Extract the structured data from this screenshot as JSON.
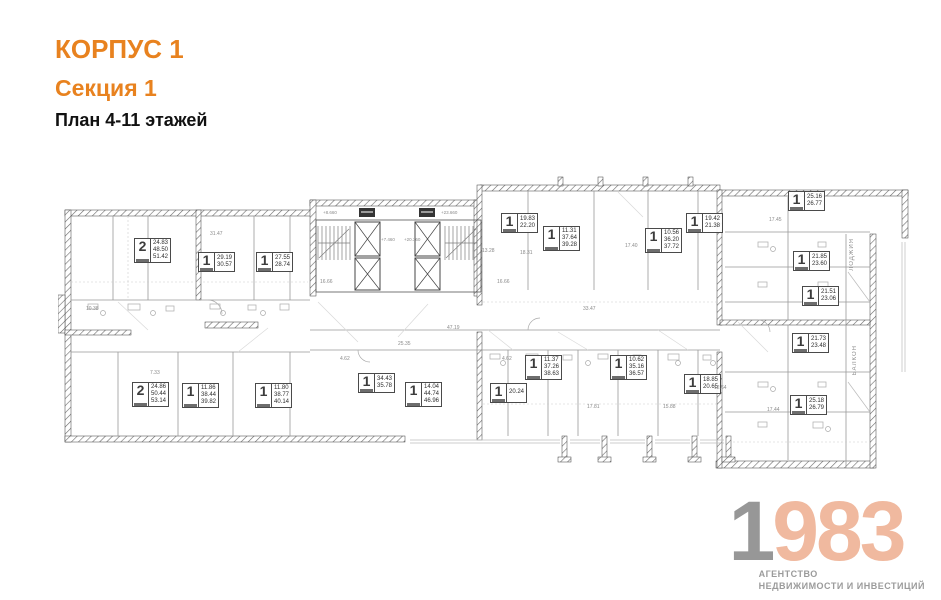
{
  "header": {
    "building": "КОРПУС 1",
    "section": "Секция 1",
    "plan": "План 4-11 этажей"
  },
  "colors": {
    "accent_orange": "#e8821f",
    "logo_gray": "#979797",
    "logo_salmon": "#f0b99f",
    "wall_line": "#4a4a4a"
  },
  "plan": {
    "apartments": [
      {
        "rooms": "2",
        "areas": [
          "24.83",
          "48.50",
          "51.42"
        ],
        "x": 134,
        "y": 238
      },
      {
        "rooms": "1",
        "areas": [
          "29.19",
          "30.57"
        ],
        "x": 198,
        "y": 252
      },
      {
        "rooms": "1",
        "areas": [
          "27.55",
          "28.74"
        ],
        "x": 256,
        "y": 252
      },
      {
        "rooms": "1",
        "areas": [
          "19.83",
          "22.20"
        ],
        "x": 501,
        "y": 213
      },
      {
        "rooms": "1",
        "areas": [
          "11.31",
          "37.64",
          "39.28"
        ],
        "x": 543,
        "y": 226
      },
      {
        "rooms": "1",
        "areas": [
          "10.56",
          "36.20",
          "37.72"
        ],
        "x": 645,
        "y": 228
      },
      {
        "rooms": "1",
        "areas": [
          "19.42",
          "21.38"
        ],
        "x": 686,
        "y": 213
      },
      {
        "rooms": "1",
        "areas": [
          "25.16",
          "26.77"
        ],
        "x": 788,
        "y": 191
      },
      {
        "rooms": "1",
        "areas": [
          "21.85",
          "23.60"
        ],
        "x": 793,
        "y": 251
      },
      {
        "rooms": "1",
        "areas": [
          "21.51",
          "23.06"
        ],
        "x": 802,
        "y": 286
      },
      {
        "rooms": "1",
        "areas": [
          "21.73",
          "23.48"
        ],
        "x": 792,
        "y": 333
      },
      {
        "rooms": "1",
        "areas": [
          "25.18",
          "26.79"
        ],
        "x": 790,
        "y": 395
      },
      {
        "rooms": "2",
        "areas": [
          "24.86",
          "50.44",
          "53.14"
        ],
        "x": 132,
        "y": 382
      },
      {
        "rooms": "1",
        "areas": [
          "11.86",
          "38.44",
          "39.82"
        ],
        "x": 182,
        "y": 383
      },
      {
        "rooms": "1",
        "areas": [
          "11.80",
          "38.77",
          "40.14"
        ],
        "x": 255,
        "y": 383
      },
      {
        "rooms": "1",
        "areas": [
          "34.43",
          "35.78"
        ],
        "x": 358,
        "y": 373
      },
      {
        "rooms": "1",
        "areas": [
          "14.04",
          "44.74",
          "46.96"
        ],
        "x": 405,
        "y": 382
      },
      {
        "rooms": "1",
        "areas": [
          "20.24"
        ],
        "x": 490,
        "y": 383
      },
      {
        "rooms": "1",
        "areas": [
          "11.37",
          "37.26",
          "38.63"
        ],
        "x": 525,
        "y": 355
      },
      {
        "rooms": "1",
        "areas": [
          "10.62",
          "35.16",
          "36.57"
        ],
        "x": 610,
        "y": 355
      },
      {
        "rooms": "1",
        "areas": [
          "18.85",
          "20.65"
        ],
        "x": 684,
        "y": 374
      }
    ],
    "dimensions": [
      {
        "t": "31.47",
        "x": 210,
        "y": 231
      },
      {
        "t": "16.66",
        "x": 320,
        "y": 279
      },
      {
        "t": "16.66",
        "x": 497,
        "y": 279
      },
      {
        "t": "25.35",
        "x": 398,
        "y": 341
      },
      {
        "t": "4.62",
        "x": 340,
        "y": 356
      },
      {
        "t": "4.62",
        "x": 502,
        "y": 356
      },
      {
        "t": "47.19",
        "x": 447,
        "y": 325
      },
      {
        "t": "17.40",
        "x": 625,
        "y": 243
      },
      {
        "t": "33.47",
        "x": 583,
        "y": 306
      },
      {
        "t": "18.31",
        "x": 520,
        "y": 250
      },
      {
        "t": "13.28",
        "x": 482,
        "y": 248
      },
      {
        "t": "17.45",
        "x": 769,
        "y": 217
      },
      {
        "t": "12.64",
        "x": 714,
        "y": 385
      },
      {
        "t": "17.81",
        "x": 587,
        "y": 404
      },
      {
        "t": "15.88",
        "x": 663,
        "y": 404
      },
      {
        "t": "17.44",
        "x": 767,
        "y": 407
      },
      {
        "t": "10.38",
        "x": 86,
        "y": 306
      },
      {
        "t": "7.33",
        "x": 150,
        "y": 370
      }
    ],
    "elevations": [
      {
        "t": "+8.660",
        "x": 323,
        "y": 210
      },
      {
        "t": "+23.660",
        "x": 441,
        "y": 210
      },
      {
        "t": "+7.460",
        "x": 381,
        "y": 237
      },
      {
        "t": "+20.360",
        "x": 404,
        "y": 237
      }
    ],
    "vertical_labels": [
      {
        "t": "ЛОДЖИЯ",
        "x": 849,
        "y": 238
      },
      {
        "t": "БАЛКОН",
        "x": 852,
        "y": 345
      }
    ]
  },
  "logo": {
    "year_first": "1",
    "year_rest": "983",
    "line1": "АГЕНТСТВО",
    "line2": "НЕДВИЖИМОСТИ И ИНВЕСТИЦИЙ"
  }
}
